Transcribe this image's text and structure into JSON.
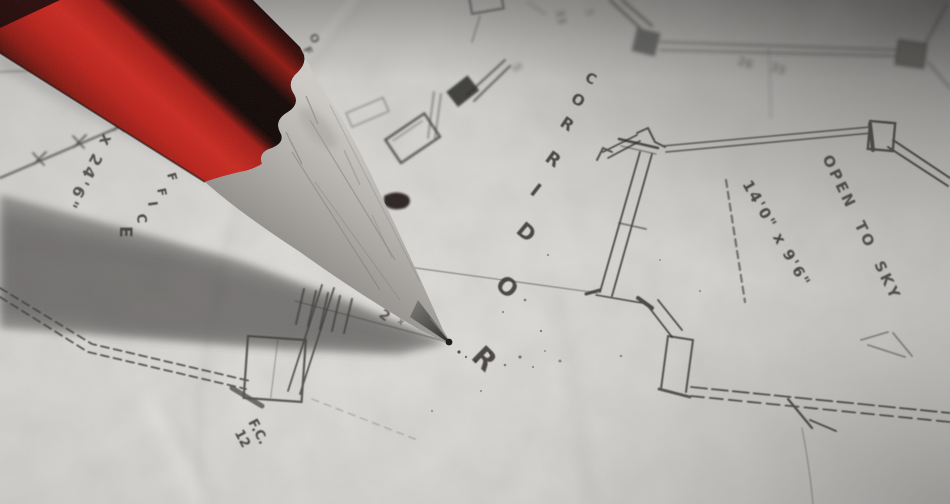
{
  "photo": {
    "subject": "red drafting pencil resting tip-down on a hand-drawn architectural floor plan",
    "colors": {
      "pencil_red": "#b92019",
      "pencil_red_bright": "#c8271e",
      "pencil_black": "#0d0806",
      "wood": "#b5b2ae",
      "graphite": "#3c3a38",
      "paper": "#d8d7d4",
      "ink": "#2e2c29",
      "shadow": "#45433f"
    },
    "plan": {
      "corridor": "CORRIDOR",
      "office_upper": "OFFICE",
      "office_left": "OFFICE",
      "dim_office": "0' x 24'6\"",
      "open_to_sky": "OPEN TO SKY",
      "dim_courtyard": "14'0\" x 9'6\"",
      "note_fc": "F.C.",
      "note_fc_num": "12",
      "tick_note": "2",
      "tick_mark": "x",
      "faint_notes": [
        "33",
        "5",
        "26",
        "35",
        "3"
      ]
    }
  }
}
